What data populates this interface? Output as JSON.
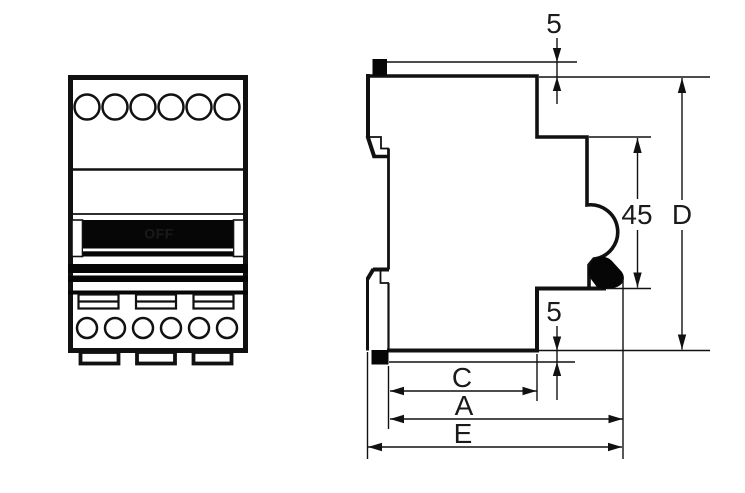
{
  "figure": {
    "front_view": {
      "switch_label": "OFF"
    },
    "side_view": {
      "dimensions": {
        "top_protrusion": "5",
        "handle_recess_height": "45",
        "overall_height": "D",
        "bottom_protrusion": "5",
        "depth_c": "C",
        "depth_a": "A",
        "depth_e": "E"
      }
    },
    "colors": {
      "line": "#111111",
      "background": "#ffffff",
      "toggle_fill": "#060606",
      "label_on_toggle": "#ffffff"
    }
  }
}
